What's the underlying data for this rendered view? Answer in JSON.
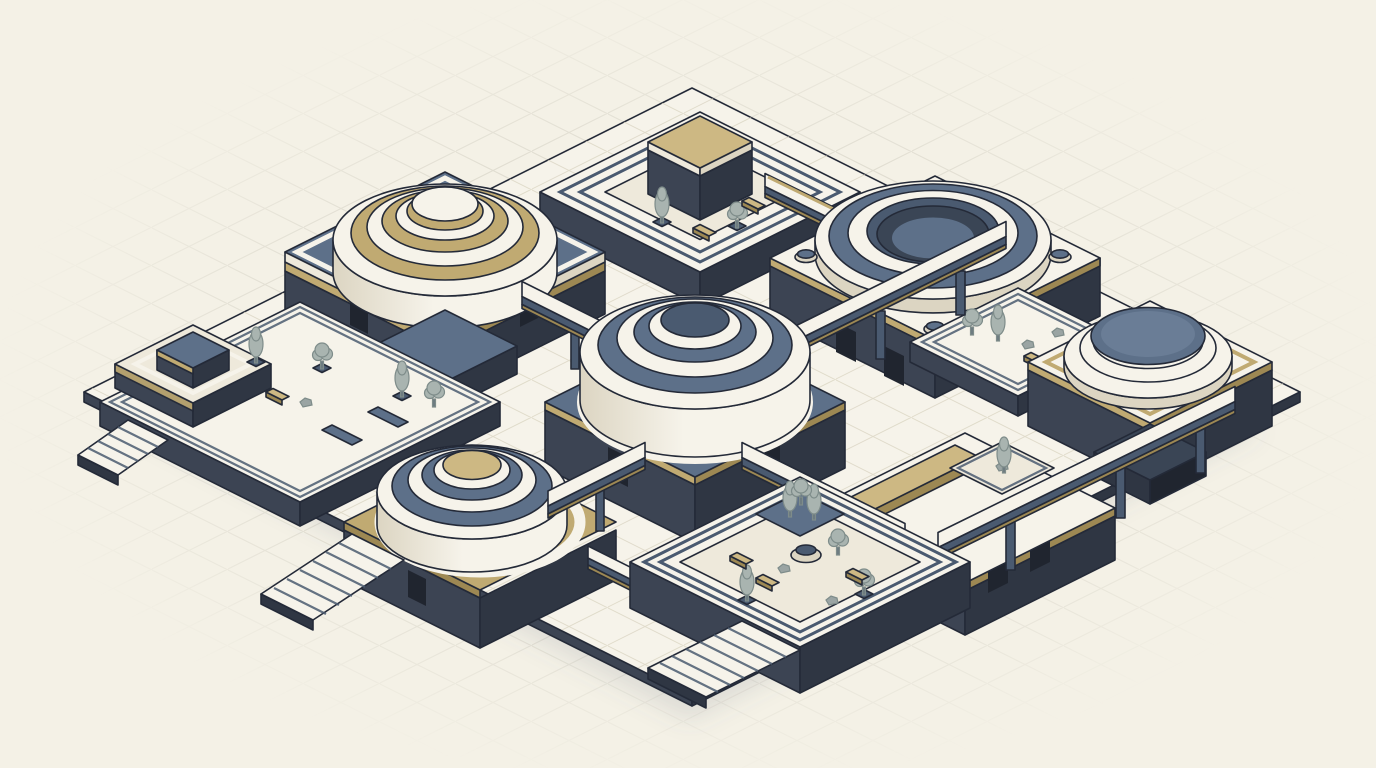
{
  "meta": {
    "description": "Flat isometric line-art illustration of a monumental civic complex: nine stone structures with tiered domes, a ring arena, sunken garden courtyards and stair terraces, all linked by elevated walkways, drawn on cream paper with a faint isometric grid.",
    "image_type": "illustration",
    "canvas": {
      "width": 1376,
      "height": 768
    }
  },
  "palette": {
    "paper": "#f4f1e6",
    "grid": "#c7c4b6",
    "tile": "#d6d0bd",
    "cream": "#eee9db",
    "creamLight": "#f6f3ea",
    "creamShade": "#dcd5c2",
    "slate": "#5d7089",
    "slateLight": "#7b8ea6",
    "slateMid": "#4a5a70",
    "slateDark": "#3a4555",
    "charcoal": "#3c4453",
    "charcoalDark": "#2f3643",
    "tan": "#c0aa72",
    "tanLight": "#cdb883",
    "tanDark": "#9d8853",
    "outline": "#242a38",
    "treeGreen": "#a9b4b0",
    "treeDark": "#7e8c8a",
    "trunk": "#6d7a80",
    "rock": "#9aa4a3",
    "door": "#20252f",
    "shadow": "rgba(100,108,128,0.16)"
  },
  "scene": {
    "structures": [
      {
        "id": "north-sunken-courtyard",
        "label": "Sunken stepped courtyard with gold-topped tower, trees and benches"
      },
      {
        "id": "northwest-dome-hall",
        "label": "Slate-roofed hall with tiered tan-and-white dome"
      },
      {
        "id": "northeast-ring-arena",
        "label": "Open ring arena on white podium with corner dome studs"
      },
      {
        "id": "arena-garden-terrace",
        "label": "Lower garden terrace with trees, rocks and bench"
      },
      {
        "id": "west-garden-plaza",
        "label": "Terraced garden plaza with podium cube, trees, hedges and west stairs"
      },
      {
        "id": "central-rotunda",
        "label": "Central rotunda with tiered blue-gray dome, four radiating bridges"
      },
      {
        "id": "east-dome-pavilion",
        "label": "Pavilion with round stepped pedestal and flat slate dome"
      },
      {
        "id": "southeast-podium-terrace",
        "label": "Podium terrace with long gold slab and small statue court"
      },
      {
        "id": "southwest-dome-hall",
        "label": "Gold-decked hall with tiered white dome and broad west staircase"
      },
      {
        "id": "south-garden-courtyard",
        "label": "Elevated garden courtyard with fountain, tree mound and cascade stairs"
      }
    ],
    "connectors": [
      {
        "id": "bridge-center-northeast",
        "from": "central-rotunda",
        "to": "northeast-ring-arena"
      },
      {
        "id": "bridge-center-northwest",
        "from": "central-rotunda",
        "to": "northwest-dome-hall"
      },
      {
        "id": "bridge-center-southwest",
        "from": "central-rotunda",
        "to": "southwest-dome-hall"
      },
      {
        "id": "bridge-center-southeast",
        "from": "central-rotunda",
        "to": "southeast-podium-terrace"
      },
      {
        "id": "walkway-north-to-northeast",
        "from": "north-sunken-courtyard",
        "to": "northeast-ring-arena"
      },
      {
        "id": "bridge-east-front",
        "from": "southeast-podium-terrace",
        "to": "east-dome-pavilion"
      },
      {
        "id": "bridge-southwest-to-south",
        "from": "southwest-dome-hall",
        "to": "south-garden-courtyard"
      }
    ],
    "vegetation": {
      "trees": 14,
      "hedges": 2,
      "rocks": 5
    },
    "furniture": {
      "benches": 7,
      "fountains": 1,
      "statues": 1
    }
  }
}
